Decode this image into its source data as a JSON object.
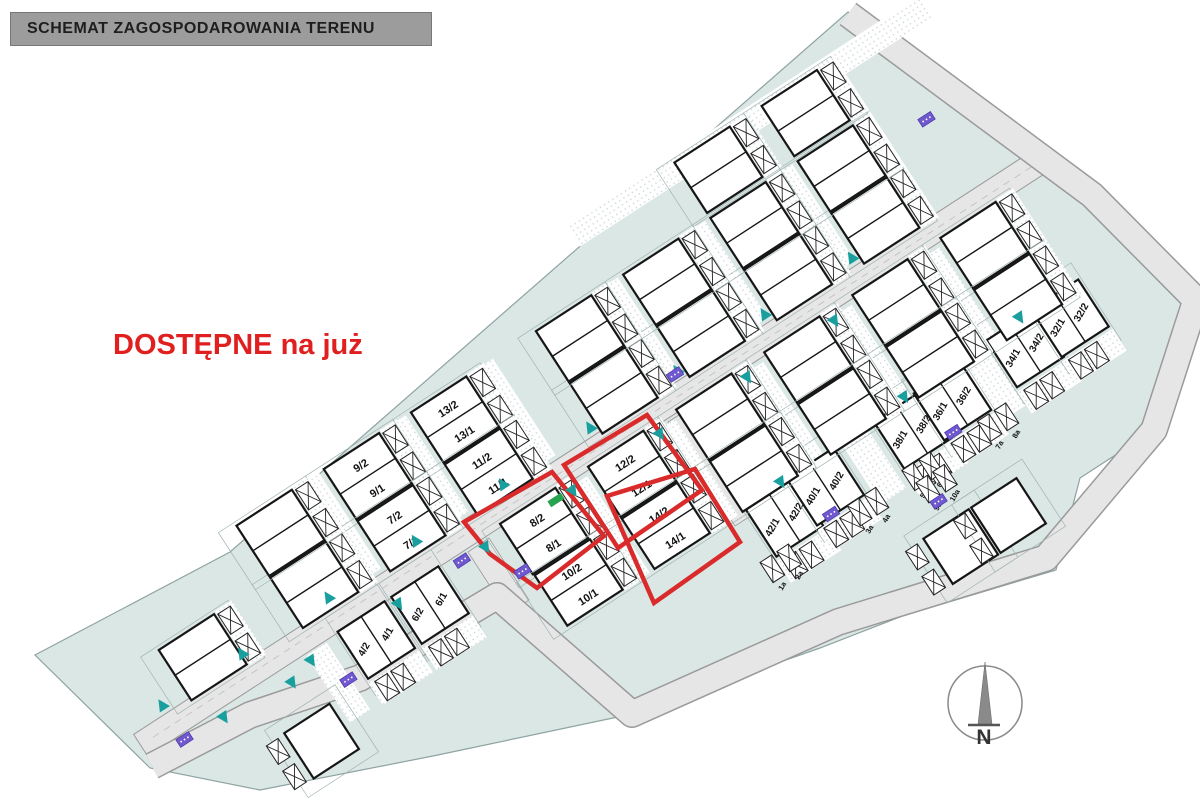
{
  "title": "SCHEMAT ZAGOSPODAROWANIA TERENU",
  "availability_note": "DOSTĘPNE na już",
  "compass_label": "N",
  "colors": {
    "estate": "#dbe7e5",
    "estate_edge": "#8fa3a2",
    "road": "#e6e6e6",
    "road_edge": "#9a9a9a",
    "building": "#ffffff",
    "building_edge": "#161616",
    "parcel_line": "#9fb3b2",
    "highlight": "#d92b2b",
    "arrow": "#1a9f9f",
    "utility": "#7059cf",
    "green_mark": "#27a350",
    "title_bg": "#9c9c9c",
    "note_color": "#e01f1f"
  },
  "plan": {
    "angle_deg": -33,
    "origin": [
      560,
      473
    ],
    "estate_outline": [
      [
        35,
        655
      ],
      [
        230,
        552
      ],
      [
        848,
        12
      ],
      [
        1092,
        195
      ],
      [
        1196,
        300
      ],
      [
        1154,
        430
      ],
      [
        1080,
        478
      ],
      [
        1056,
        570
      ],
      [
        905,
        615
      ],
      [
        820,
        648
      ],
      [
        632,
        714
      ],
      [
        433,
        756
      ],
      [
        260,
        790
      ],
      [
        150,
        768
      ]
    ],
    "perimeter_road": [
      [
        152,
        766
      ],
      [
        250,
        715
      ],
      [
        360,
        678
      ],
      [
        497,
        596
      ],
      [
        632,
        714
      ],
      [
        838,
        622
      ],
      [
        1046,
        558
      ],
      [
        1154,
        430
      ],
      [
        1196,
        300
      ],
      [
        1092,
        195
      ],
      [
        848,
        14
      ]
    ],
    "main_road": {
      "t1": -500,
      "t2": 575,
      "half_width": 13
    },
    "connectors": [
      [
        [
          668,
          422
        ],
        [
          693,
          406
        ],
        [
          760,
          510
        ],
        [
          735,
          526
        ]
      ],
      [
        [
          468,
          552
        ],
        [
          489,
          538
        ],
        [
          529,
          600
        ],
        [
          508,
          614
        ]
      ]
    ],
    "available_lot_ids": [
      "8",
      "12",
      "14"
    ],
    "lots": [
      {
        "id": "9",
        "type": "stack",
        "t": -163,
        "s": -102,
        "labels": [
          "9/2",
          "9/1"
        ]
      },
      {
        "id": "7",
        "type": "stack",
        "t": -163,
        "s": -40,
        "labels": [
          "7/2",
          "7/1"
        ]
      },
      {
        "id": "13",
        "type": "stack",
        "t": -59,
        "s": -102,
        "labels": [
          "13/2",
          "13/1"
        ]
      },
      {
        "id": "11",
        "type": "stack",
        "t": -59,
        "s": -40,
        "labels": [
          "11/2",
          "11/1"
        ]
      },
      {
        "id": "8",
        "type": "stack",
        "t": -45,
        "s": 40,
        "labels": [
          "8/2",
          "8/1"
        ],
        "available": true
      },
      {
        "id": "10",
        "type": "stack",
        "t": -44,
        "s": 102,
        "labels": [
          "10/2",
          "10/1"
        ]
      },
      {
        "id": "12",
        "type": "stack",
        "t": 60,
        "s": 40,
        "labels": [
          "12/2",
          "12/1"
        ],
        "available": true
      },
      {
        "id": "14",
        "type": "stack",
        "t": 60,
        "s": 102,
        "labels": [
          "14/2",
          "14/1"
        ],
        "available": true
      },
      {
        "id": "4",
        "type": "row",
        "t": -245,
        "s": 40,
        "labels": [
          "4/2",
          "4/1"
        ]
      },
      {
        "id": "6",
        "type": "row",
        "t": -181,
        "s": 40,
        "labels": [
          "6/2",
          "6/1"
        ]
      },
      {
        "id": "42",
        "type": "row",
        "t": 164,
        "s": 160,
        "labels": [
          "42/1",
          "42/2"
        ]
      },
      {
        "id": "40",
        "type": "row",
        "t": 215,
        "s": 156,
        "labels": [
          "40/1",
          "40/2"
        ]
      },
      {
        "id": "38",
        "type": "row",
        "t": 319,
        "s": 156,
        "labels": [
          "38/1",
          "38/2"
        ]
      },
      {
        "id": "36",
        "type": "row",
        "t": 368,
        "s": 154,
        "labels": [
          "36/1",
          "36/2"
        ]
      },
      {
        "id": "34",
        "type": "row",
        "t": 458,
        "s": 149,
        "labels": [
          "34/1",
          "34/2"
        ]
      },
      {
        "id": "32",
        "type": "row",
        "t": 512,
        "s": 148,
        "labels": [
          "32/1",
          "32/2"
        ]
      },
      {
        "id": "",
        "type": "stack",
        "t": -400,
        "s": -40,
        "labels": [
          "",
          ""
        ]
      },
      {
        "id": "",
        "type": "stack",
        "t": -267,
        "s": -40,
        "labels": [
          "",
          ""
        ]
      },
      {
        "id": "",
        "type": "stack",
        "t": 90,
        "s": -40,
        "labels": [
          "",
          ""
        ]
      },
      {
        "id": "",
        "type": "stack",
        "t": 194,
        "s": -40,
        "labels": [
          "",
          ""
        ]
      },
      {
        "id": "",
        "type": "stack",
        "t": 298,
        "s": -40,
        "labels": [
          "",
          ""
        ]
      },
      {
        "id": "",
        "type": "stack",
        "t": 402,
        "s": -40,
        "labels": [
          "",
          ""
        ]
      },
      {
        "id": "",
        "type": "stack",
        "t": -267,
        "s": -102,
        "labels": [
          "",
          ""
        ]
      },
      {
        "id": "",
        "type": "stack",
        "t": 90,
        "s": -102,
        "labels": [
          "",
          ""
        ]
      },
      {
        "id": "",
        "type": "stack",
        "t": 194,
        "s": -102,
        "labels": [
          "",
          ""
        ]
      },
      {
        "id": "",
        "type": "stack",
        "t": 298,
        "s": -102,
        "labels": [
          "",
          ""
        ]
      },
      {
        "id": "",
        "type": "stack",
        "t": 402,
        "s": -102,
        "labels": [
          "",
          ""
        ]
      },
      {
        "id": "",
        "type": "stack",
        "t": 298,
        "s": -168,
        "labels": [
          "",
          ""
        ]
      },
      {
        "id": "",
        "type": "stack",
        "t": 402,
        "s": -168,
        "labels": [
          "",
          ""
        ]
      },
      {
        "id": "",
        "type": "stack",
        "t": 165,
        "s": 40,
        "labels": [
          "",
          ""
        ]
      },
      {
        "id": "",
        "type": "stack",
        "t": 270,
        "s": 40,
        "labels": [
          "",
          ""
        ]
      },
      {
        "id": "",
        "type": "stack",
        "t": 375,
        "s": 40,
        "labels": [
          "",
          ""
        ]
      },
      {
        "id": "",
        "type": "stack",
        "t": 480,
        "s": 40,
        "labels": [
          "",
          ""
        ]
      },
      {
        "id": "",
        "type": "stack",
        "t": 165,
        "s": 102,
        "labels": [
          "",
          ""
        ]
      },
      {
        "id": "",
        "type": "stack",
        "t": 270,
        "s": 102,
        "labels": [
          "",
          ""
        ]
      },
      {
        "id": "",
        "type": "stack",
        "t": 375,
        "s": 102,
        "labels": [
          "",
          ""
        ]
      },
      {
        "id": "",
        "type": "stack",
        "t": 480,
        "s": 102,
        "labels": [
          "",
          ""
        ]
      },
      {
        "id": "",
        "type": "single",
        "t": 296,
        "s": 280,
        "labels": [
          "",
          ""
        ]
      },
      {
        "id": "",
        "type": "single",
        "t": 353,
        "s": 280,
        "labels": [
          "",
          ""
        ]
      },
      {
        "id": "",
        "type": "single",
        "t": -346,
        "s": 95,
        "labels": [
          "",
          ""
        ]
      }
    ],
    "red_outlines": [
      [
        [
          552,
          472
        ],
        [
          604,
          536
        ],
        [
          537,
          588
        ],
        [
          490,
          554
        ],
        [
          464,
          522
        ],
        [
          524,
          488
        ]
      ],
      [
        [
          647,
          415
        ],
        [
          702,
          490
        ],
        [
          618,
          548
        ],
        [
          564,
          465
        ]
      ],
      [
        [
          695,
          469
        ],
        [
          740,
          542
        ],
        [
          654,
          603
        ],
        [
          607,
          496
        ]
      ]
    ],
    "green_marks": [
      [
        556,
        500
      ]
    ],
    "parking_spots": [
      {
        "label": "1a",
        "t": 126,
        "s": 196
      },
      {
        "label": "2a",
        "t": 146,
        "s": 196
      },
      {
        "label": "3a",
        "t": 230,
        "s": 196
      },
      {
        "label": "4a",
        "t": 250,
        "s": 196
      },
      {
        "label": "5a",
        "t": 295,
        "s": 196
      },
      {
        "label": "6a",
        "t": 315,
        "s": 196
      },
      {
        "label": "7a",
        "t": 385,
        "s": 196
      },
      {
        "label": "8a",
        "t": 405,
        "s": 196
      },
      {
        "label": "9a",
        "t": 300,
        "s": 214
      },
      {
        "label": "10a",
        "t": 320,
        "s": 214
      }
    ],
    "hatch_strips": [
      {
        "t": -215,
        "s": -75,
        "w": 26,
        "h": 115
      },
      {
        "t": -111,
        "s": -75,
        "w": 26,
        "h": 115
      },
      {
        "t": -7,
        "s": -75,
        "w": 26,
        "h": 115
      },
      {
        "t": 142,
        "s": -75,
        "w": 26,
        "h": 115
      },
      {
        "t": 246,
        "s": -75,
        "w": 26,
        "h": 115
      },
      {
        "t": 350,
        "s": -75,
        "w": 26,
        "h": 115
      },
      {
        "t": 8,
        "s": 75,
        "w": 26,
        "h": 115
      },
      {
        "t": 113,
        "s": 75,
        "w": 26,
        "h": 115
      },
      {
        "t": 218,
        "s": 75,
        "w": 26,
        "h": 115
      },
      {
        "t": 323,
        "s": 75,
        "w": 26,
        "h": 115
      },
      {
        "t": 428,
        "s": 75,
        "w": 26,
        "h": 115
      },
      {
        "t": 267,
        "s": 156,
        "w": 30,
        "h": 90
      },
      {
        "t": 412,
        "s": 152,
        "w": 30,
        "h": 90
      },
      {
        "t": -300,
        "s": 55,
        "w": 24,
        "h": 80
      },
      {
        "t": 350,
        "s": -192,
        "w": 420,
        "h": 26
      }
    ],
    "arrows": [
      {
        "t": -460,
        "s": -22
      },
      {
        "t": -365,
        "s": -22
      },
      {
        "t": -262,
        "s": -22
      },
      {
        "t": -158,
        "s": -22
      },
      {
        "t": -54,
        "s": -22
      },
      {
        "t": 50,
        "s": -22
      },
      {
        "t": 154,
        "s": -22
      },
      {
        "t": 258,
        "s": -22
      },
      {
        "t": 362,
        "s": -22
      },
      {
        "t": -415,
        "s": 22
      },
      {
        "t": -311,
        "s": 22
      },
      {
        "t": -207,
        "s": 22
      },
      {
        "t": -103,
        "s": 22
      },
      {
        "t": 1,
        "s": 22
      },
      {
        "t": 105,
        "s": 22
      },
      {
        "t": 209,
        "s": 22
      },
      {
        "t": 313,
        "s": 22
      },
      {
        "t": -339,
        "s": 30
      },
      {
        "t": 180,
        "s": 128
      },
      {
        "t": 330,
        "s": 124
      },
      {
        "t": 470,
        "s": 120
      }
    ],
    "utility_boxes": [
      {
        "t": -460,
        "s": 19
      },
      {
        "t": -290,
        "s": 58
      },
      {
        "t": -130,
        "s": 20
      },
      {
        "t": -85,
        "s": 62
      },
      {
        "t": 150,
        "s": -20
      },
      {
        "t": 500,
        "s": -97
      },
      {
        "t": 205,
        "s": 182
      },
      {
        "t": 352,
        "s": 180
      },
      {
        "t": 302,
        "s": 230
      }
    ]
  }
}
